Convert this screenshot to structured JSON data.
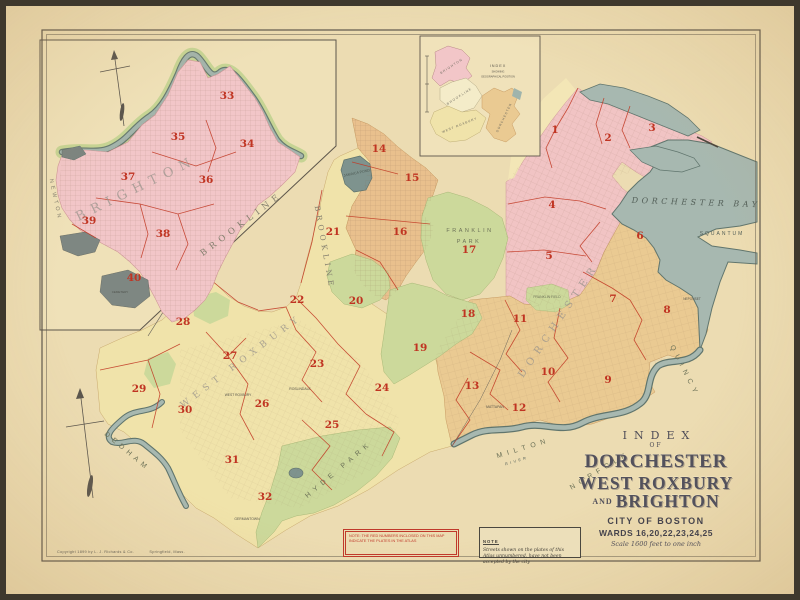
{
  "title_block": {
    "index": "INDEX",
    "of": "OF",
    "line1": "DORCHESTER",
    "line2": "WEST ROXBURY",
    "and": "AND",
    "line3": "BRIGHTON",
    "city": "CITY OF BOSTON",
    "wards": "WARDS 16,20,22,23,24,25",
    "scale": "Scale 1600 feet to one inch"
  },
  "notes": {
    "red_note": "Note: the red numbers inclosed on this map indicate the plates in the atlas",
    "black_note_title": "NOTE",
    "black_note_body": "Streets shown on the plates of this Atlas unnumbered, have not been accepted by the city"
  },
  "copyright": {
    "left": "Copyright 1899 by L. J. Richards & Co.",
    "right": "Springfield, Mass."
  },
  "colors": {
    "parchment": "#ecdcb2",
    "water": "#a7b8b0",
    "water_edge": "#60756d",
    "brighton_pink": "#f2c6c8",
    "dorchester_pink": "#f1c4c4",
    "west_roxbury_yellow": "#f0e3aa",
    "dorchester_tan": "#eaca92",
    "roxbury_orange": "#e9c08d",
    "park_green": "#ccd99b",
    "plate_red": "#c03422"
  },
  "plate_numbers": [
    {
      "n": "1",
      "x": 555,
      "y": 133
    },
    {
      "n": "2",
      "x": 608,
      "y": 141
    },
    {
      "n": "3",
      "x": 652,
      "y": 131
    },
    {
      "n": "4",
      "x": 552,
      "y": 208
    },
    {
      "n": "5",
      "x": 549,
      "y": 259
    },
    {
      "n": "6",
      "x": 640,
      "y": 239
    },
    {
      "n": "7",
      "x": 613,
      "y": 302
    },
    {
      "n": "8",
      "x": 667,
      "y": 313
    },
    {
      "n": "9",
      "x": 608,
      "y": 383
    },
    {
      "n": "10",
      "x": 548,
      "y": 375
    },
    {
      "n": "11",
      "x": 520,
      "y": 322
    },
    {
      "n": "12",
      "x": 519,
      "y": 411
    },
    {
      "n": "13",
      "x": 472,
      "y": 389
    },
    {
      "n": "14",
      "x": 379,
      "y": 152
    },
    {
      "n": "15",
      "x": 412,
      "y": 181
    },
    {
      "n": "16",
      "x": 400,
      "y": 235
    },
    {
      "n": "17",
      "x": 469,
      "y": 253
    },
    {
      "n": "18",
      "x": 468,
      "y": 317
    },
    {
      "n": "19",
      "x": 420,
      "y": 351
    },
    {
      "n": "20",
      "x": 356,
      "y": 304
    },
    {
      "n": "21",
      "x": 333,
      "y": 235
    },
    {
      "n": "22",
      "x": 297,
      "y": 303
    },
    {
      "n": "23",
      "x": 317,
      "y": 367
    },
    {
      "n": "24",
      "x": 382,
      "y": 391
    },
    {
      "n": "25",
      "x": 332,
      "y": 428
    },
    {
      "n": "26",
      "x": 262,
      "y": 407
    },
    {
      "n": "27",
      "x": 230,
      "y": 359
    },
    {
      "n": "28",
      "x": 183,
      "y": 325
    },
    {
      "n": "29",
      "x": 139,
      "y": 392
    },
    {
      "n": "30",
      "x": 185,
      "y": 413
    },
    {
      "n": "31",
      "x": 232,
      "y": 463
    },
    {
      "n": "32",
      "x": 265,
      "y": 500
    },
    {
      "n": "33",
      "x": 227,
      "y": 99
    },
    {
      "n": "34",
      "x": 247,
      "y": 147
    },
    {
      "n": "35",
      "x": 178,
      "y": 140
    },
    {
      "n": "36",
      "x": 206,
      "y": 183
    },
    {
      "n": "37",
      "x": 128,
      "y": 180
    },
    {
      "n": "38",
      "x": 163,
      "y": 237
    },
    {
      "n": "39",
      "x": 89,
      "y": 224
    },
    {
      "n": "40",
      "x": 134,
      "y": 281
    }
  ],
  "map_labels": [
    {
      "t": "BRIGHTON",
      "x": 138,
      "y": 192,
      "r": -26,
      "fs": 13,
      "ls": 7,
      "c": "#9a948c",
      "f": "serif",
      "o": 0.75
    },
    {
      "t": "BROOKLINE",
      "x": 243,
      "y": 226,
      "r": -37,
      "fs": 8.5,
      "ls": 5,
      "c": "#847f6e",
      "f": "serif"
    },
    {
      "t": "BROOKLINE",
      "x": 322,
      "y": 248,
      "r": 80,
      "fs": 7.5,
      "ls": 4,
      "c": "#847f6e",
      "f": "serif"
    },
    {
      "t": "NEWTON",
      "x": 54,
      "y": 200,
      "r": 78,
      "fs": 5.5,
      "ls": 3,
      "c": "#847f6e"
    },
    {
      "t": "JAMAICA POND",
      "x": 357,
      "y": 174,
      "r": -12,
      "fs": 3.6,
      "c": "#4e5a54"
    },
    {
      "t": "FRANKLIN",
      "x": 470,
      "y": 232,
      "r": 0,
      "fs": 5.5,
      "ls": 2.5,
      "c": "#6d7258"
    },
    {
      "t": "PARK",
      "x": 469,
      "y": 243,
      "r": 0,
      "fs": 5.5,
      "ls": 2.5,
      "c": "#6d7258"
    },
    {
      "t": "FRANKLIN FIELD",
      "x": 547,
      "y": 298,
      "r": 0,
      "fs": 3.4,
      "c": "#6d7258"
    },
    {
      "t": "WEST ROXBURY",
      "x": 243,
      "y": 363,
      "r": -37,
      "fs": 9,
      "ls": 6,
      "c": "#9a948c",
      "f": "serif",
      "o": 0.8
    },
    {
      "t": "DORCHESTER",
      "x": 561,
      "y": 322,
      "r": -56,
      "fs": 10,
      "ls": 6,
      "c": "#9a948c",
      "f": "serif",
      "o": 0.8
    },
    {
      "t": "DORCHESTER BAY",
      "x": 696,
      "y": 205,
      "r": 2,
      "fs": 8,
      "ls": 3.5,
      "c": "#535f58",
      "f": "serif-italic"
    },
    {
      "t": "SQUANTUM",
      "x": 722,
      "y": 235,
      "r": 0,
      "fs": 5,
      "ls": 2,
      "c": "#535f58"
    },
    {
      "t": "QUINCY",
      "x": 683,
      "y": 372,
      "r": 63,
      "fs": 7,
      "ls": 5,
      "c": "#6d7258"
    },
    {
      "t": "MILTON",
      "x": 524,
      "y": 450,
      "r": -17,
      "fs": 7,
      "ls": 5,
      "c": "#6d7258"
    },
    {
      "t": "RIVER",
      "x": 517,
      "y": 462,
      "r": -17,
      "fs": 3.8,
      "ls": 2.5,
      "c": "#535f58"
    },
    {
      "t": "NORFOLK",
      "x": 601,
      "y": 472,
      "r": -31,
      "fs": 7,
      "ls": 5,
      "c": "#6d7258"
    },
    {
      "t": "DEDHAM",
      "x": 126,
      "y": 453,
      "r": 40,
      "fs": 7,
      "ls": 4.5,
      "c": "#6d7258"
    },
    {
      "t": "HYDE PARK",
      "x": 340,
      "y": 471,
      "r": -40,
      "fs": 7,
      "ls": 5,
      "c": "#6d7258"
    },
    {
      "t": "GERMANTOWN",
      "x": 247,
      "y": 520,
      "r": 0,
      "fs": 3.4,
      "c": "#57544a"
    },
    {
      "t": "MATTAPAN",
      "x": 495,
      "y": 408,
      "r": 0,
      "fs": 3.4,
      "c": "#57544a"
    },
    {
      "t": "NEPONSET",
      "x": 692,
      "y": 300,
      "r": 0,
      "fs": 3.2,
      "c": "#57544a"
    },
    {
      "t": "ROSLINDALE",
      "x": 300,
      "y": 390,
      "r": 0,
      "fs": 3.4,
      "c": "#57544a"
    },
    {
      "t": "WEST ROXBURY",
      "x": 238,
      "y": 396,
      "r": 0,
      "fs": 3.3,
      "c": "#57544a"
    },
    {
      "t": "CEMETERY",
      "x": 120,
      "y": 293,
      "r": 0,
      "fs": 3,
      "c": "#50544e"
    },
    {
      "t": "INDEX",
      "x": 498,
      "y": 67,
      "r": 0,
      "fs": 3.8,
      "ls": 1,
      "c": "#5a564c"
    },
    {
      "t": "SHOWING",
      "x": 498,
      "y": 72.5,
      "r": 0,
      "fs": 2.6,
      "c": "#5a564c"
    },
    {
      "t": "GEOGRAPHICAL POSITION",
      "x": 498,
      "y": 77.5,
      "r": 0,
      "fs": 2.6,
      "c": "#5a564c"
    },
    {
      "t": "BRIGHTON",
      "x": 452,
      "y": 67,
      "r": -33,
      "fs": 3.2,
      "ls": 1.2,
      "c": "#6e6a5e"
    },
    {
      "t": "BROOKLINE",
      "x": 460,
      "y": 97,
      "r": -33,
      "fs": 3.2,
      "ls": 1.2,
      "c": "#6e6a5e"
    },
    {
      "t": "WEST ROXBURY",
      "x": 460,
      "y": 126,
      "r": -22,
      "fs": 3.2,
      "ls": 1,
      "c": "#6e6a5e"
    },
    {
      "t": "DORCHESTER",
      "x": 505,
      "y": 118,
      "r": -64,
      "fs": 3.2,
      "ls": 1,
      "c": "#6e6a5e"
    }
  ]
}
